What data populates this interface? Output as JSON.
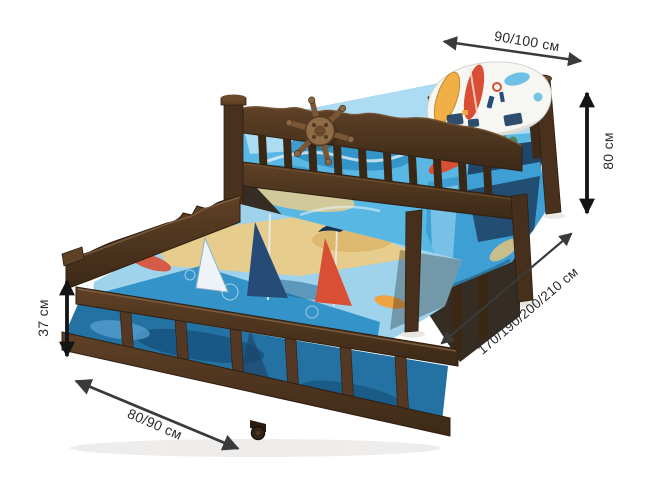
{
  "image": {
    "type": "product-photo-with-dimensions",
    "subject": "Wooden kids trundle bed with pull-out lower bed, windsurfing print bedding, decorative ship wheel",
    "background": "#ffffff"
  },
  "annotations": {
    "color": "#3a3a3a",
    "color_bold": "#141414",
    "text_color": "#2b2b2b",
    "upper_bed_width": {
      "label": "90/100 см"
    },
    "upper_bed_height": {
      "label": "80 см"
    },
    "bed_length": {
      "label": "170/190/200/210 см"
    },
    "trundle_height": {
      "label": "37 см"
    },
    "trundle_width": {
      "label": "80/90 см"
    }
  },
  "illustration_colors": {
    "wood": "#573b25",
    "wood_dark": "#3b2817",
    "wood_light": "#8a6848",
    "bedding_blue": "#3e9fd4",
    "bedding_light": "#9fd3ec",
    "sand": "#e7cd8d",
    "accent_red": "#d94f35",
    "accent_orange": "#f2a13c",
    "navy": "#274b77",
    "pillow_white": "#f6f6f3"
  }
}
